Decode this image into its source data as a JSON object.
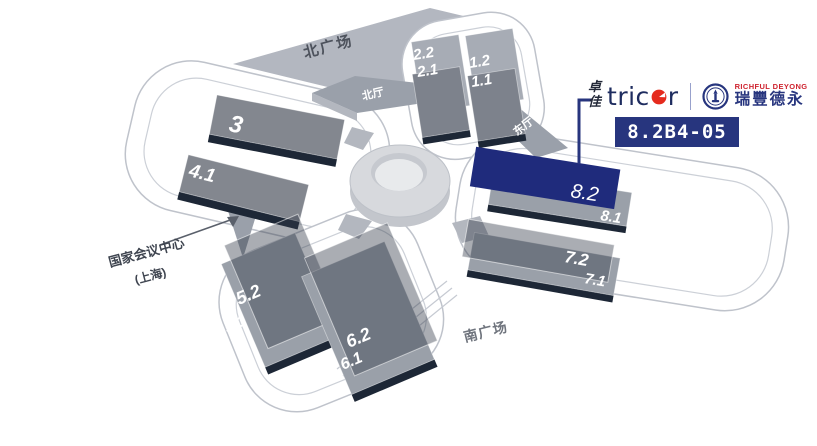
{
  "branding": {
    "tricor_cn_top": "卓",
    "tricor_cn_bottom": "佳",
    "tricor_prefix": "tric",
    "tricor_suffix": "r",
    "richful_en": "RICHFUL DEYONG",
    "richful_cn": "瑞豐德永",
    "booth_number": "8.2B4-05"
  },
  "colors": {
    "navy": "#27357e",
    "highlight_navy": "#1f2b7c",
    "logo_red": "#e52a1d",
    "richful_red": "#cf2430",
    "hall_gray": "#83878f",
    "plaza_gray": "#b3b7c0",
    "edge_navy": "#1d2736"
  },
  "map": {
    "labels": {
      "north_plaza": "北广场",
      "north_hall": "北厅",
      "east_hall": "东厅",
      "south_plaza": "南广场",
      "convention_center_l1": "国家会议中心",
      "convention_center_l2": "(上海)"
    },
    "highlighted_hall": "8.2",
    "halls": [
      {
        "label": "2.2"
      },
      {
        "label": "2.1"
      },
      {
        "label": "1.2"
      },
      {
        "label": "1.1"
      },
      {
        "label": "3"
      },
      {
        "label": "4.1"
      },
      {
        "label": "5.2"
      },
      {
        "label": "5.1"
      },
      {
        "label": "6.2"
      },
      {
        "label": "6.1"
      },
      {
        "label": "7.2"
      },
      {
        "label": "7.1"
      },
      {
        "label": "8.1"
      },
      {
        "label": "8.2",
        "highlighted": true
      }
    ]
  }
}
